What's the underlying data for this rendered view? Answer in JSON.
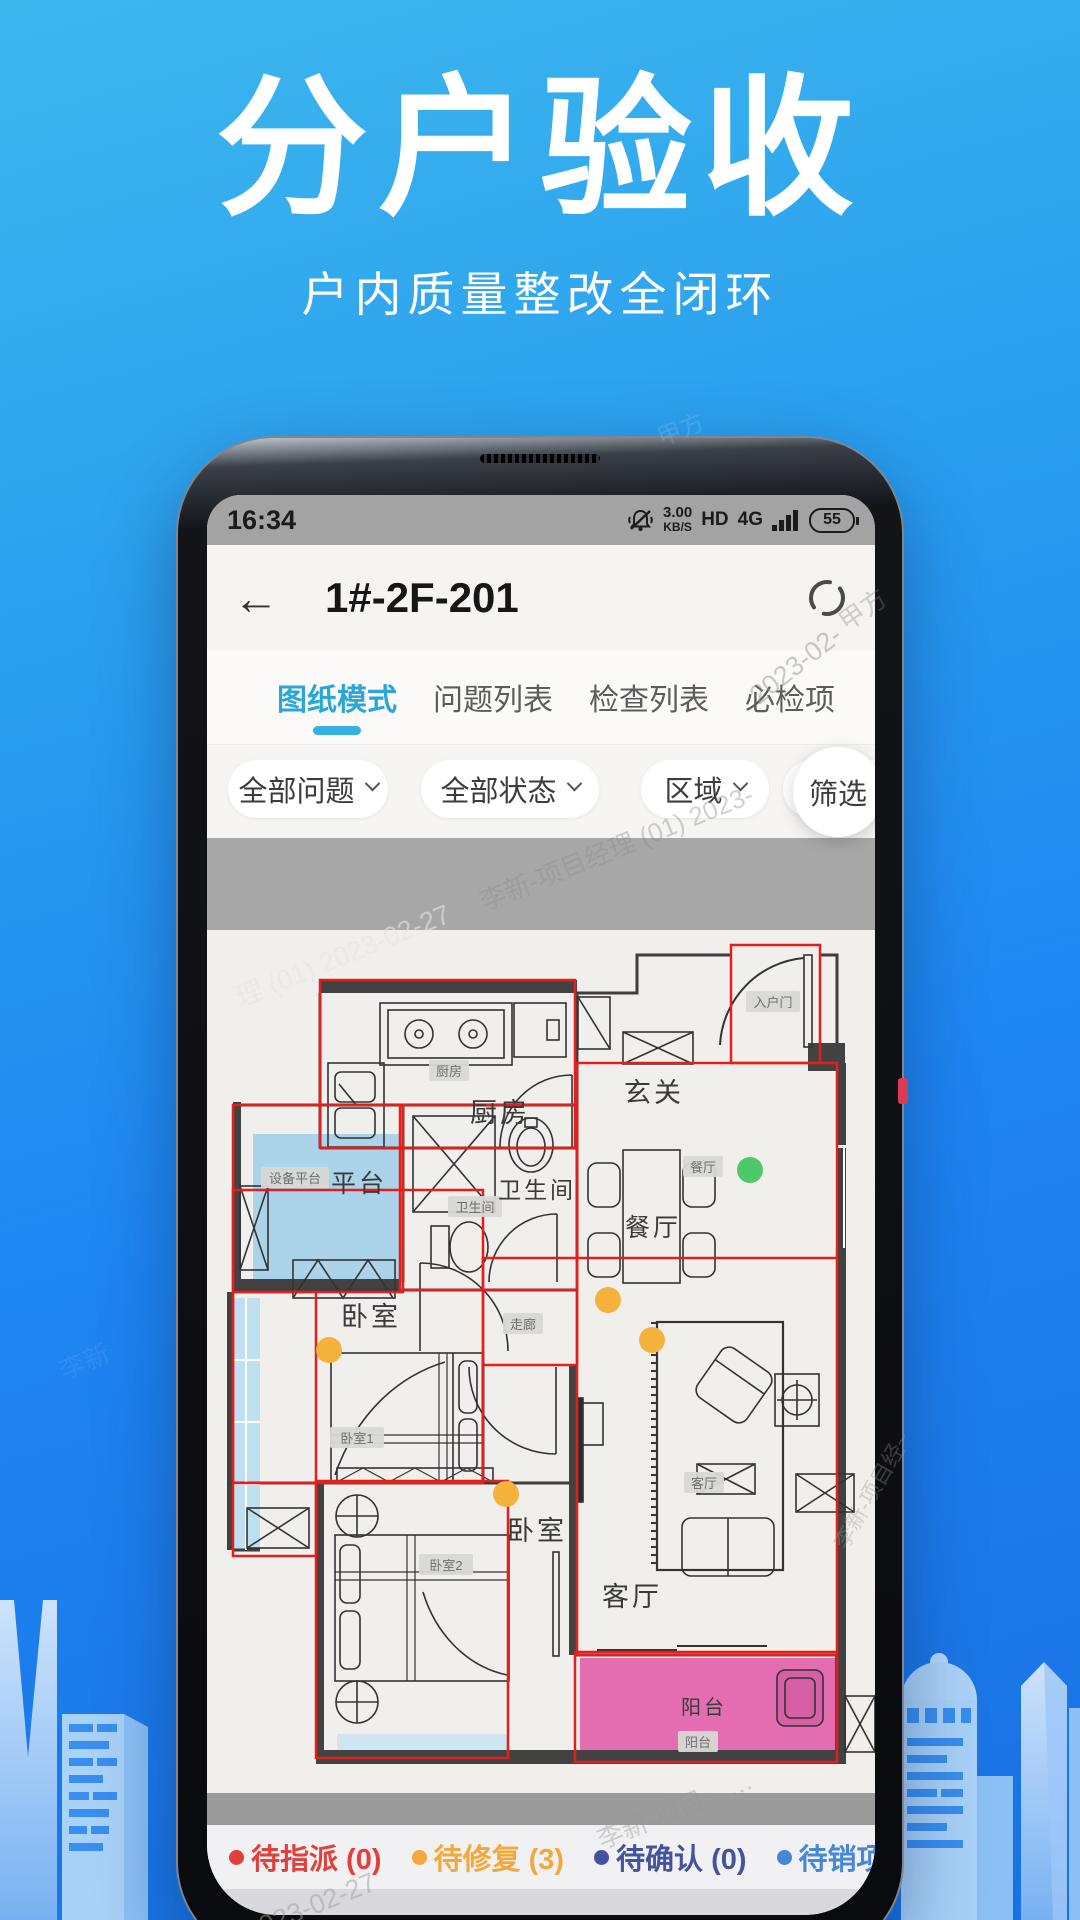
{
  "hero": {
    "title": "分户验收",
    "subtitle": "户内质量整改全闭环"
  },
  "statusbar": {
    "time": "16:34",
    "net_speed": "3.00",
    "net_unit": "KB/S",
    "hd_label": "HD",
    "net_type": "4G",
    "battery_level": "55"
  },
  "nav": {
    "title": "1#-2F-201"
  },
  "tabs": [
    {
      "label": "图纸模式",
      "active": true
    },
    {
      "label": "问题列表",
      "active": false
    },
    {
      "label": "检查列表",
      "active": false
    },
    {
      "label": "必检项",
      "active": false
    }
  ],
  "filters": [
    {
      "label": "全部问题",
      "chevron": true,
      "left": 21,
      "width": 160
    },
    {
      "label": "全部状态",
      "chevron": true,
      "left": 214,
      "width": 178
    },
    {
      "label": "区域",
      "chevron": true,
      "left": 434,
      "width": 128
    },
    {
      "label": "检查项",
      "chevron": false,
      "left": 576,
      "width": 118
    },
    {
      "label": "筛选",
      "chevron": false,
      "left": 586,
      "circle": true
    }
  ],
  "floorplan": {
    "accent_red": "#e1201e",
    "tags": [
      {
        "text": "厨房",
        "x": 242,
        "y": 141
      },
      {
        "text": "入户门",
        "x": 566,
        "y": 72
      },
      {
        "text": "设备平台",
        "x": 88,
        "y": 248
      },
      {
        "text": "卫生间",
        "x": 268,
        "y": 277
      },
      {
        "text": "餐厅",
        "x": 496,
        "y": 237
      },
      {
        "text": "走廊",
        "x": 316,
        "y": 394
      },
      {
        "text": "卧室1",
        "x": 150,
        "y": 508
      },
      {
        "text": "客厅",
        "x": 497,
        "y": 553
      },
      {
        "text": "卧室2",
        "x": 239,
        "y": 635
      },
      {
        "text": "阳台",
        "x": 491,
        "y": 812
      }
    ],
    "room_labels": [
      {
        "text": "厨房",
        "x": 293,
        "y": 192,
        "size": 27
      },
      {
        "text": "玄关",
        "x": 447,
        "y": 172,
        "size": 27
      },
      {
        "text": "平台",
        "x": 152,
        "y": 262,
        "size": 25
      },
      {
        "text": "卫生间",
        "x": 330,
        "y": 268,
        "size": 23
      },
      {
        "text": "餐厅",
        "x": 446,
        "y": 306,
        "size": 25
      },
      {
        "text": "卧室",
        "x": 164,
        "y": 396,
        "size": 27
      },
      {
        "text": "卧室",
        "x": 330,
        "y": 610,
        "size": 27
      },
      {
        "text": "客厅",
        "x": 425,
        "y": 676,
        "size": 27
      },
      {
        "text": "阳台",
        "x": 497,
        "y": 784,
        "size": 20
      }
    ],
    "red_boxes": [
      [
        113,
        50,
        255,
        168
      ],
      [
        524,
        15,
        89,
        118
      ],
      [
        26,
        175,
        170,
        187
      ],
      [
        193,
        175,
        177,
        185
      ],
      [
        370,
        133,
        260,
        592
      ],
      [
        276,
        328,
        94,
        107
      ],
      [
        26,
        260,
        250,
        293
      ],
      [
        26,
        362,
        83,
        264
      ],
      [
        109,
        551,
        192,
        277
      ],
      [
        368,
        722,
        262,
        110
      ]
    ],
    "red_lines": [
      [
        370,
        328,
        630,
        328
      ]
    ],
    "dots": [
      {
        "x": 543,
        "y": 240,
        "color": "#4fc86a"
      },
      {
        "x": 122,
        "y": 420,
        "color": "#f5b23c"
      },
      {
        "x": 299,
        "y": 564,
        "color": "#f5b23c"
      },
      {
        "x": 401,
        "y": 370,
        "color": "#f5b23c"
      },
      {
        "x": 445,
        "y": 410,
        "color": "#f5b23c"
      }
    ]
  },
  "legend": {
    "items": [
      {
        "label": "待指派",
        "count": "0",
        "color": "#e2403a"
      },
      {
        "label": "待修复",
        "count": "3",
        "color": "#f3a83b"
      },
      {
        "label": "待确认",
        "count": "0",
        "color": "#45539f"
      },
      {
        "label": "待销项",
        "count": "0",
        "color": "#4687d7"
      },
      {
        "label": "已销项",
        "count": "1",
        "color": "#32b46b"
      },
      {
        "label": "记",
        "count": null,
        "color": "#3aa9db"
      }
    ]
  },
  "watermarks": [
    {
      "text": "甲方",
      "x": 836,
      "y": 590,
      "rot": -35,
      "size": 26,
      "color": "rgba(130,130,130,0.35)"
    },
    {
      "text": "2023-02-",
      "x": 742,
      "y": 650,
      "rot": -38,
      "size": 27,
      "color": "rgba(140,140,140,0.45)"
    },
    {
      "text": "李新-项目经理 (01) 2023-",
      "x": 470,
      "y": 828,
      "rot": -22,
      "size": 26,
      "color": "rgba(140,140,140,0.40)"
    },
    {
      "text": "理 (01)  2023-02-27",
      "x": 228,
      "y": 934,
      "rot": -22,
      "size": 27,
      "color": "rgba(228,228,228,0.60)"
    },
    {
      "text": "李新-项目经~",
      "x": 806,
      "y": 1474,
      "rot": -60,
      "size": 22,
      "color": "rgba(150,150,150,0.35)"
    },
    {
      "text": "李新-项目……",
      "x": 592,
      "y": 1790,
      "rot": -22,
      "size": 26,
      "color": "rgba(150,150,150,0.42)"
    },
    {
      "text": "(01)  2023-02-27",
      "x": 188,
      "y": 1902,
      "rot": -22,
      "size": 27,
      "color": "rgba(160,160,160,0.50)"
    },
    {
      "text": "李新",
      "x": 58,
      "y": 1342,
      "rot": -22,
      "size": 26,
      "color": "rgba(255,255,255,0.08)"
    },
    {
      "text": "甲方",
      "x": 656,
      "y": 410,
      "rot": -22,
      "size": 24,
      "color": "rgba(255,255,255,0.12)"
    }
  ]
}
